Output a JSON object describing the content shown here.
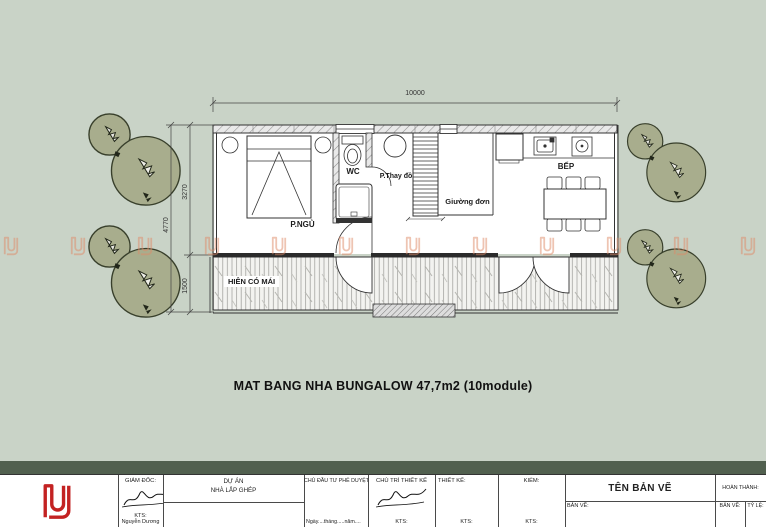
{
  "plan": {
    "title": "MAT BANG NHA BUNGALOW 47,7m2 (10module)",
    "rooms": {
      "bedroom": "P.NGỦ",
      "wc": "WC",
      "changing": "P.Thay đồ",
      "single_bed": "Giường đơn",
      "kitchen": "BẾP",
      "porch": "HIÊN CÓ MÁI"
    },
    "dimensions": {
      "width_total": "10000",
      "height_total": "4770",
      "height_main": "3270",
      "height_porch": "1500"
    }
  },
  "watermarks": {
    "count": 12,
    "glyph": "dsd-logo"
  },
  "title_block": {
    "logo_text": "DSD",
    "director_label": "GIÁM ĐỐC:",
    "director_title": "KTS:",
    "director_name": "Nguyễn Dương",
    "project_label": "DỰ ÁN",
    "project_name": "NHÀ LẮP GHÉP",
    "investor_label": "CHỦ ĐẦU TƯ PHÊ DUYỆT",
    "investor_date": "Ngày....tháng.....năm....",
    "lead_label": "CHỦ TRÌ THIẾT KẾ",
    "lead_title": "KTS:",
    "designer_label": "THIẾT KẾ:",
    "designer_title": "KTS:",
    "checker_label": "KIỂM:",
    "checker_title": "KTS:",
    "drawing_name_label": "TÊN BẢN VẼ",
    "drawing_label": "BẢN VẼ:",
    "completed_label": "HOÀN THÀNH:",
    "sheet_label": "BẢN VẼ:",
    "scale_label": "TỶ LỆ:"
  },
  "colors": {
    "background": "#c9d3c7",
    "tree_fill": "#a8ad8d",
    "tree_stroke": "#383f2b",
    "watermark": "#df8a68",
    "logo_red": "#c32222",
    "line": "#333333"
  }
}
